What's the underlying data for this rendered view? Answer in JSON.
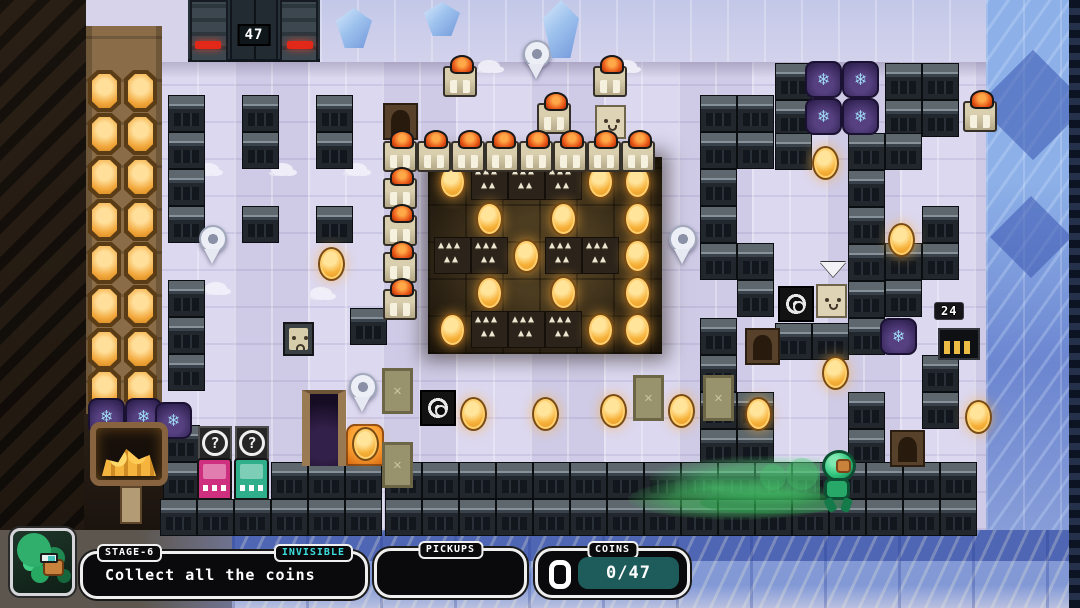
{
  "hud": {
    "stage_label": "STAGE-6",
    "modifier_label": "INVISIBLE",
    "objective_text": "Collect all the coins",
    "pickups_label": "PICKUPS",
    "coins_label": "COINS",
    "coins_count": "0/47"
  },
  "counters": {
    "gate_door": "47",
    "coin_gate": "24"
  },
  "colors": {
    "accent_cyan": "#3ce0e0",
    "coin_gold": "#f2a83c",
    "counter_teal": "#1d5c5a",
    "alert_red": "#e22818",
    "machine_pink": "#cf2f7f",
    "machine_teal": "#2fae8c"
  },
  "board": {
    "tile_size": 37,
    "metal_blocks": [
      [
        168,
        95,
        1,
        4
      ],
      [
        242,
        95,
        1,
        2
      ],
      [
        316,
        95,
        1,
        2
      ],
      [
        242,
        206,
        1,
        1
      ],
      [
        316,
        206,
        1,
        1
      ],
      [
        168,
        280,
        1,
        3
      ],
      [
        350,
        308,
        1,
        1
      ],
      [
        163,
        425,
        1,
        2
      ],
      [
        271,
        462,
        3,
        1
      ],
      [
        700,
        95,
        1,
        5
      ],
      [
        737,
        95,
        1,
        2
      ],
      [
        775,
        63,
        1,
        2
      ],
      [
        885,
        63,
        2,
        2
      ],
      [
        775,
        133,
        1,
        1
      ],
      [
        848,
        133,
        2,
        1
      ],
      [
        737,
        243,
        1,
        2
      ],
      [
        848,
        170,
        1,
        5
      ],
      [
        885,
        243,
        1,
        2
      ],
      [
        922,
        206,
        1,
        2
      ],
      [
        775,
        323,
        2,
        1
      ],
      [
        700,
        318,
        1,
        4
      ],
      [
        737,
        392,
        1,
        2
      ],
      [
        848,
        392,
        1,
        2
      ],
      [
        922,
        355,
        1,
        2
      ],
      [
        385,
        462,
        16,
        2
      ],
      [
        160,
        499,
        6,
        1
      ]
    ],
    "pit": {
      "x": 434,
      "y": 163,
      "cell": 37,
      "pattern": [
        "CSSSCC",
        ".C.C.C",
        "SSCSSC",
        ".C.C.C",
        "CSSSCC"
      ]
    },
    "coins": [
      [
        318,
        247
      ],
      [
        812,
        146
      ],
      [
        888,
        223
      ],
      [
        822,
        356
      ],
      [
        965,
        400
      ],
      [
        460,
        397
      ],
      [
        532,
        397
      ],
      [
        600,
        394
      ],
      [
        668,
        394
      ],
      [
        745,
        397
      ],
      [
        352,
        427
      ]
    ],
    "big_coin_grid": {
      "cols": [
        88,
        124
      ],
      "rows": [
        70,
        113,
        156,
        199,
        242,
        285,
        328,
        368
      ]
    },
    "robots": [
      [
        443,
        66
      ],
      [
        537,
        103
      ],
      [
        593,
        66
      ],
      [
        963,
        101
      ],
      [
        383,
        141
      ],
      [
        417,
        141
      ],
      [
        451,
        141
      ],
      [
        485,
        141
      ],
      [
        519,
        141
      ],
      [
        553,
        141
      ],
      [
        587,
        141
      ],
      [
        621,
        141
      ],
      [
        383,
        178
      ],
      [
        383,
        215
      ],
      [
        383,
        252
      ],
      [
        383,
        289
      ]
    ],
    "pins": [
      [
        522,
        40
      ],
      [
        198,
        225
      ],
      [
        668,
        225
      ],
      [
        348,
        373
      ]
    ],
    "barrels": [
      [
        88,
        398
      ],
      [
        125,
        398
      ],
      [
        155,
        402
      ],
      [
        805,
        61
      ],
      [
        842,
        61
      ],
      [
        805,
        98
      ],
      [
        842,
        98
      ],
      [
        880,
        318
      ]
    ],
    "crates": [
      [
        382,
        368
      ],
      [
        382,
        442
      ],
      [
        633,
        375
      ],
      [
        703,
        375
      ]
    ],
    "brown_doors": [
      [
        383,
        103
      ],
      [
        745,
        328
      ],
      [
        890,
        430
      ]
    ],
    "question_blocks": [
      [
        198,
        426
      ],
      [
        235,
        426
      ]
    ],
    "machines": [
      {
        "x": 197,
        "y": 458,
        "color": "#cf2f7f"
      },
      {
        "x": 234,
        "y": 458,
        "color": "#2fae8c"
      }
    ],
    "face_blocks": [
      {
        "x": 595,
        "y": 105,
        "variant": "light"
      },
      {
        "x": 283,
        "y": 322,
        "variant": "dark"
      },
      {
        "x": 816,
        "y": 284,
        "variant": "light"
      }
    ],
    "camera_blocks": [
      [
        778,
        286
      ],
      [
        420,
        390
      ]
    ],
    "arrows": [
      [
        820,
        262
      ]
    ],
    "pedestals": [
      [
        346,
        424
      ]
    ],
    "ice_crystals": [
      {
        "x": 543,
        "y": 0,
        "h": 58
      },
      {
        "x": 336,
        "y": 8,
        "h": 40
      },
      {
        "x": 424,
        "y": 2,
        "h": 34
      }
    ],
    "snow_patches": [
      [
        197,
        163
      ],
      [
        271,
        163
      ],
      [
        345,
        163
      ],
      [
        205,
        282
      ],
      [
        310,
        287
      ],
      [
        478,
        60
      ],
      [
        615,
        60
      ]
    ]
  }
}
